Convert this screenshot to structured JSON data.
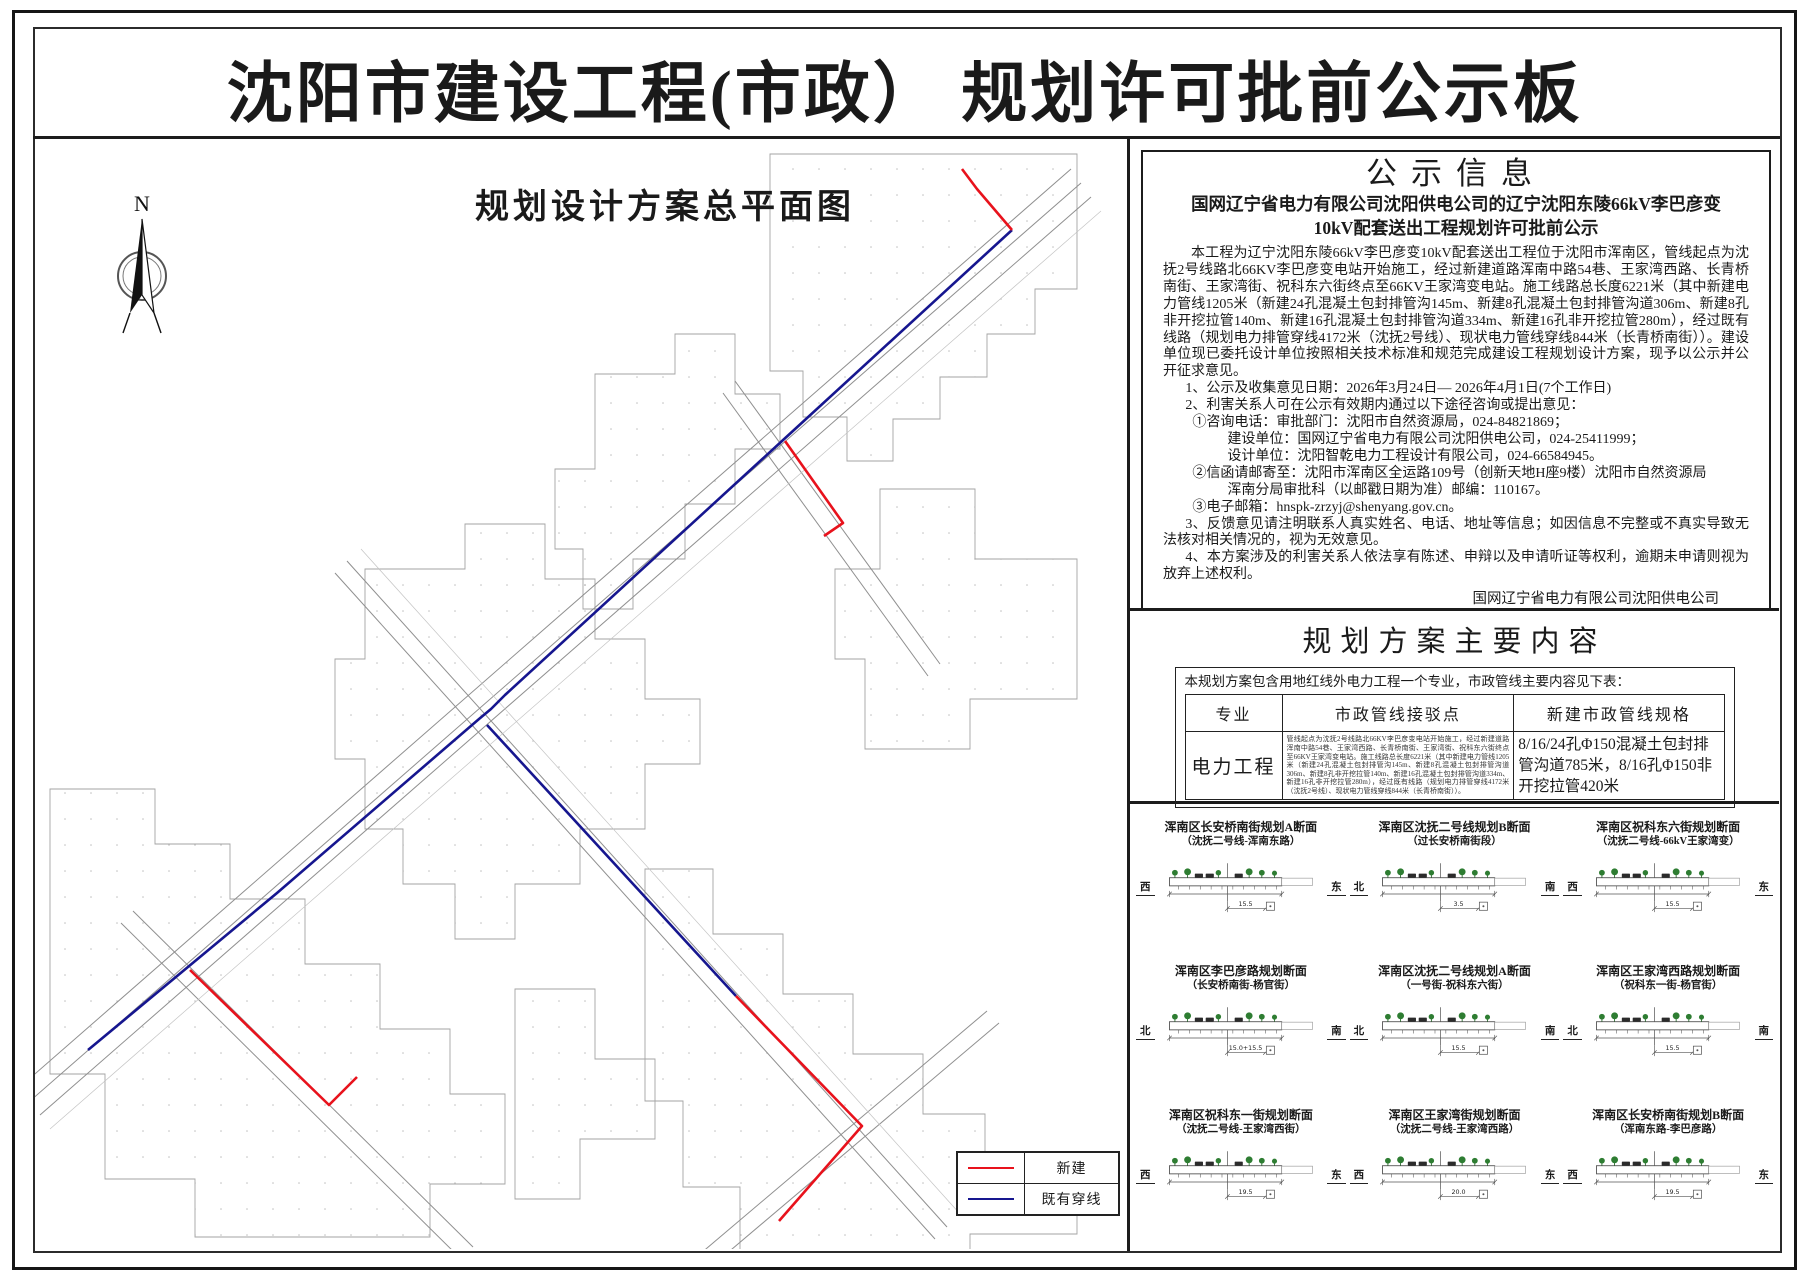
{
  "title": "沈阳市建设工程(市政） 规划许可批前公示板",
  "map": {
    "title": "规划设计方案总平面图",
    "north_label": "N",
    "legend": {
      "items": [
        {
          "label": "新建",
          "color": "#e8121c"
        },
        {
          "label": "既有穿线",
          "color": "#16168f"
        }
      ]
    }
  },
  "notice": {
    "title": "公示信息",
    "subtitle_line1": "国网辽宁省电力有限公司沈阳供电公司的辽宁沈阳东陵66kV李巴彦变",
    "subtitle_line2": "10kV配套送出工程规划许可批前公示",
    "paragraphs": [
      "本工程为辽宁沈阳东陵66kV李巴彦变10kV配套送出工程位于沈阳市浑南区，管线起点为沈抚2号线路北66KV李巴彦变电站开始施工，经过新建道路浑南中路54巷、王家湾西路、长青桥南街、王家湾街、祝科东六街终点至66KV王家湾变电站。施工线路总长度6221米（其中新建电力管线1205米（新建24孔混凝土包封排管沟145m、新建8孔混凝土包封排管沟道306m、新建8孔非开挖拉管140m、新建16孔混凝土包封排管沟道334m、新建16孔非开挖拉管280m），经过既有线路（规划电力排管穿线4172米（沈抚2号线）、现状电力管线穿线844米（长青桥南街））。建设单位现已委托设计单位按照相关技术标准和规范完成建设工程规划设计方案，现予以公示并公开征求意见。",
      "1、公示及收集意见日期：2026年3月24日— 2026年4月1日(7个工作日)",
      "2、利害关系人可在公示有效期内通过以下途径咨询或提出意见：",
      "①咨询电话：审批部门：沈阳市自然资源局，024-84821869；",
      "建设单位：国网辽宁省电力有限公司沈阳供电公司，024-25411999；",
      "设计单位：沈阳智乾电力工程设计有限公司，024-66584945。",
      "②信函请邮寄至：沈阳市浑南区全运路109号（创新天地H座9楼）沈阳市自然资源局",
      "浑南分局审批科（以邮戳日期为准）邮编：110167。",
      "③电子邮箱：hnspk-zrzyj@shenyang.gov.cn。",
      "3、反馈意见请注明联系人真实姓名、电话、地址等信息；如因信息不完整或不真实导致无法核对相关情况的，视为无效意见。",
      "4、本方案涉及的利害关系人依法享有陈述、申辩以及申请听证等权利，逾期未申请则视为放弃上述权利。"
    ],
    "signature": [
      "国网辽宁省电力有限公司沈阳供电公司",
      "沈阳市自然资源局",
      "2026年3月24日"
    ]
  },
  "plan": {
    "title": "规划方案主要内容",
    "intro": "本规划方案包含用地红线外电力工程一个专业，市政管线主要内容见下表：",
    "table": {
      "headers": [
        "专业",
        "市政管线接驳点",
        "新建市政管线规格"
      ],
      "row": {
        "major": "电力工程",
        "connection": "管线起点为沈抚2号线路北66KV李巴彦变电站开始施工，经过新建道路浑南中路54巷、王家湾西路、长青桥南街、王家湾街、祝科东六街终点至66KV王家湾变电站。施工线路总长度6221米（其中新建电力管线1205米（新建24孔混凝土包封排管沟145m、新建8孔混凝土包封排管沟道306m、新建8孔非开挖拉管140m、新建16孔混凝土包封排管沟道334m、新建16孔非开挖拉管280m），经过既有线路（规划电力排管穿线4172米（沈抚2号线）、现状电力管线穿线844米（长青桥南街））。",
        "spec": "8/16/24孔Φ150混凝土包封排管沟道785米，8/16孔Φ150非开挖拉管420米"
      }
    }
  },
  "sections": {
    "items": [
      {
        "title1": "浑南区长安桥南街规划A断面",
        "title2": "（沈抚二号线-浑南东路）",
        "dir_left": "西",
        "dir_right": "东",
        "dim": "15.5"
      },
      {
        "title1": "浑南区沈抚二号线规划B断面",
        "title2": "（过长安桥南街段）",
        "dir_left": "北",
        "dir_right": "南",
        "dim": "3.5"
      },
      {
        "title1": "浑南区祝科东六街规划断面",
        "title2": "（沈抚二号线-66kV王家湾变）",
        "dir_left": "西",
        "dir_right": "东",
        "dim": "15.5"
      },
      {
        "title1": "浑南区李巴彦路规划断面",
        "title2": "（长安桥南街-杨官街）",
        "dir_left": "北",
        "dir_right": "南",
        "dim": "15.0+15.5"
      },
      {
        "title1": "浑南区沈抚二号线规划A断面",
        "title2": "（一号街-祝科东六街）",
        "dir_left": "北",
        "dir_right": "南",
        "dim": "15.5"
      },
      {
        "title1": "浑南区王家湾西路规划断面",
        "title2": "（祝科东一街-杨官街）",
        "dir_left": "北",
        "dir_right": "南",
        "dim": "15.5"
      },
      {
        "title1": "浑南区祝科东一街规划断面",
        "title2": "（沈抚二号线-王家湾西街）",
        "dir_left": "西",
        "dir_right": "东",
        "dim": "19.5"
      },
      {
        "title1": "浑南区王家湾街规划断面",
        "title2": "（沈抚二号线-王家湾西路）",
        "dir_left": "西",
        "dir_right": "东",
        "dim": "20.0"
      },
      {
        "title1": "浑南区长安桥南街规划B断面",
        "title2": "（浑南东路-李巴彦路）",
        "dir_left": "西",
        "dir_right": "东",
        "dim": "19.5"
      }
    ]
  }
}
